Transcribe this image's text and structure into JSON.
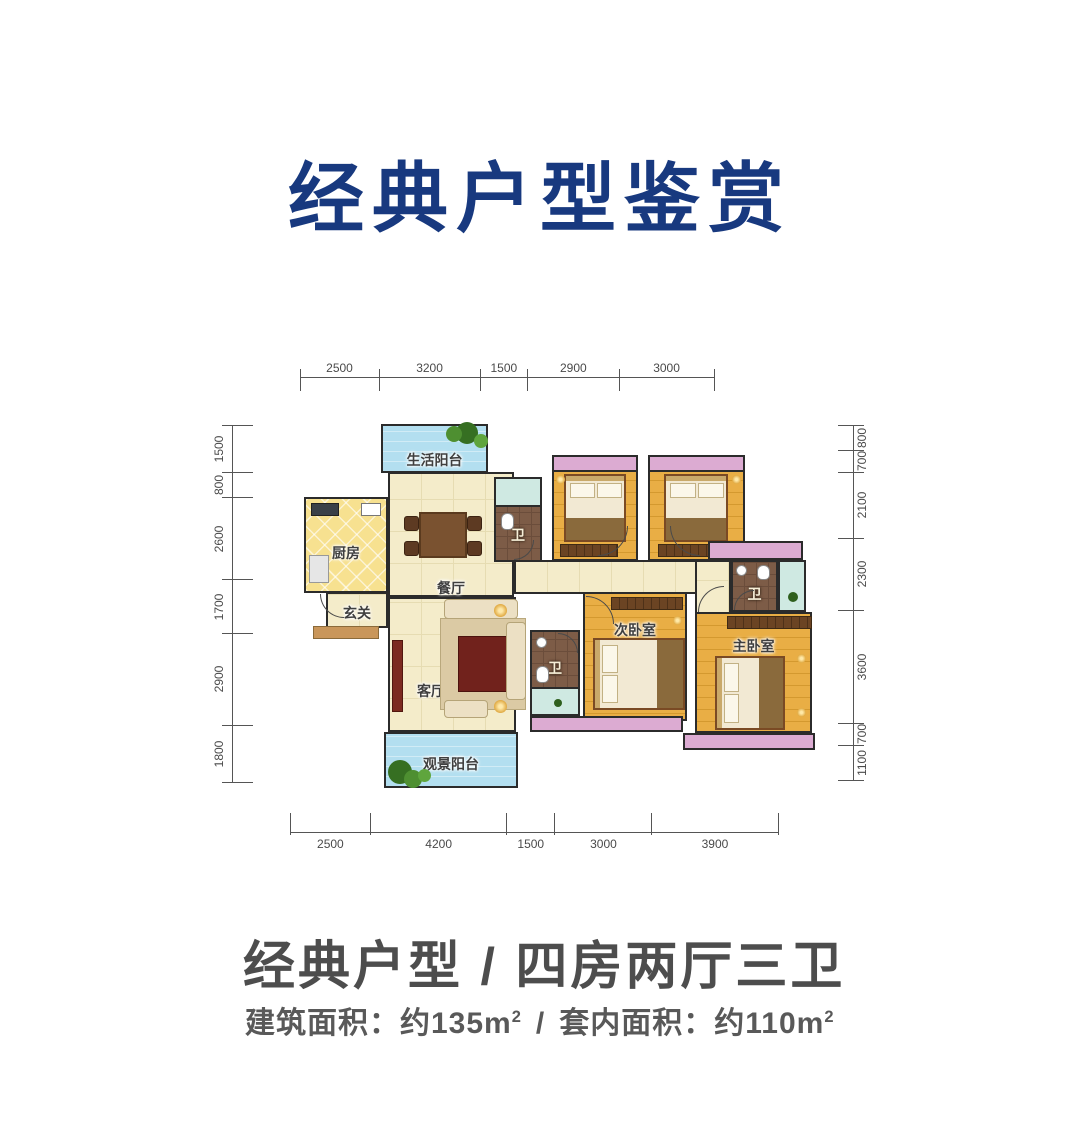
{
  "title": {
    "text": "经典户型鉴赏"
  },
  "colors": {
    "navy": "#18397f",
    "wall": "#2b2b2b",
    "cream": "#f4ecca",
    "wood": "#e9ae45",
    "kitchen": "#f7e190",
    "brown": "#7d5c47",
    "blue": "#b3dff0",
    "pink": "#dcabd2",
    "teal": "#cfe9e2",
    "text-dark": "#4d4d4d",
    "text-gray": "#595959"
  },
  "floorplan": {
    "rooms": {
      "living_balcony": "生活阳台",
      "kitchen": "厨房",
      "foyer": "玄关",
      "dining": "餐厅",
      "living": "客厅",
      "view_balcony": "观景阳台",
      "bedroom_left": "卧室",
      "bedroom_right": "卧室",
      "second_bedroom": "次卧室",
      "master_bedroom": "主卧室",
      "bath_top": "卫",
      "bath_mid": "卫",
      "bath_right": "卫"
    },
    "dimensions": {
      "top": [
        2500,
        3200,
        1500,
        2900,
        3000
      ],
      "bottom": [
        2500,
        4200,
        1500,
        3000,
        3900
      ],
      "left": [
        1500,
        800,
        2600,
        1700,
        2900,
        1800
      ],
      "right": [
        800,
        700,
        2100,
        2300,
        3600,
        700,
        1100
      ]
    }
  },
  "footer": {
    "headline": "经典户型 / 四房两厅三卫",
    "building_area_label": "建筑面积：约135m",
    "building_area_exp": "2",
    "area_divider": "/",
    "interior_area_label": "套内面积：约110m",
    "interior_area_exp": "2"
  }
}
